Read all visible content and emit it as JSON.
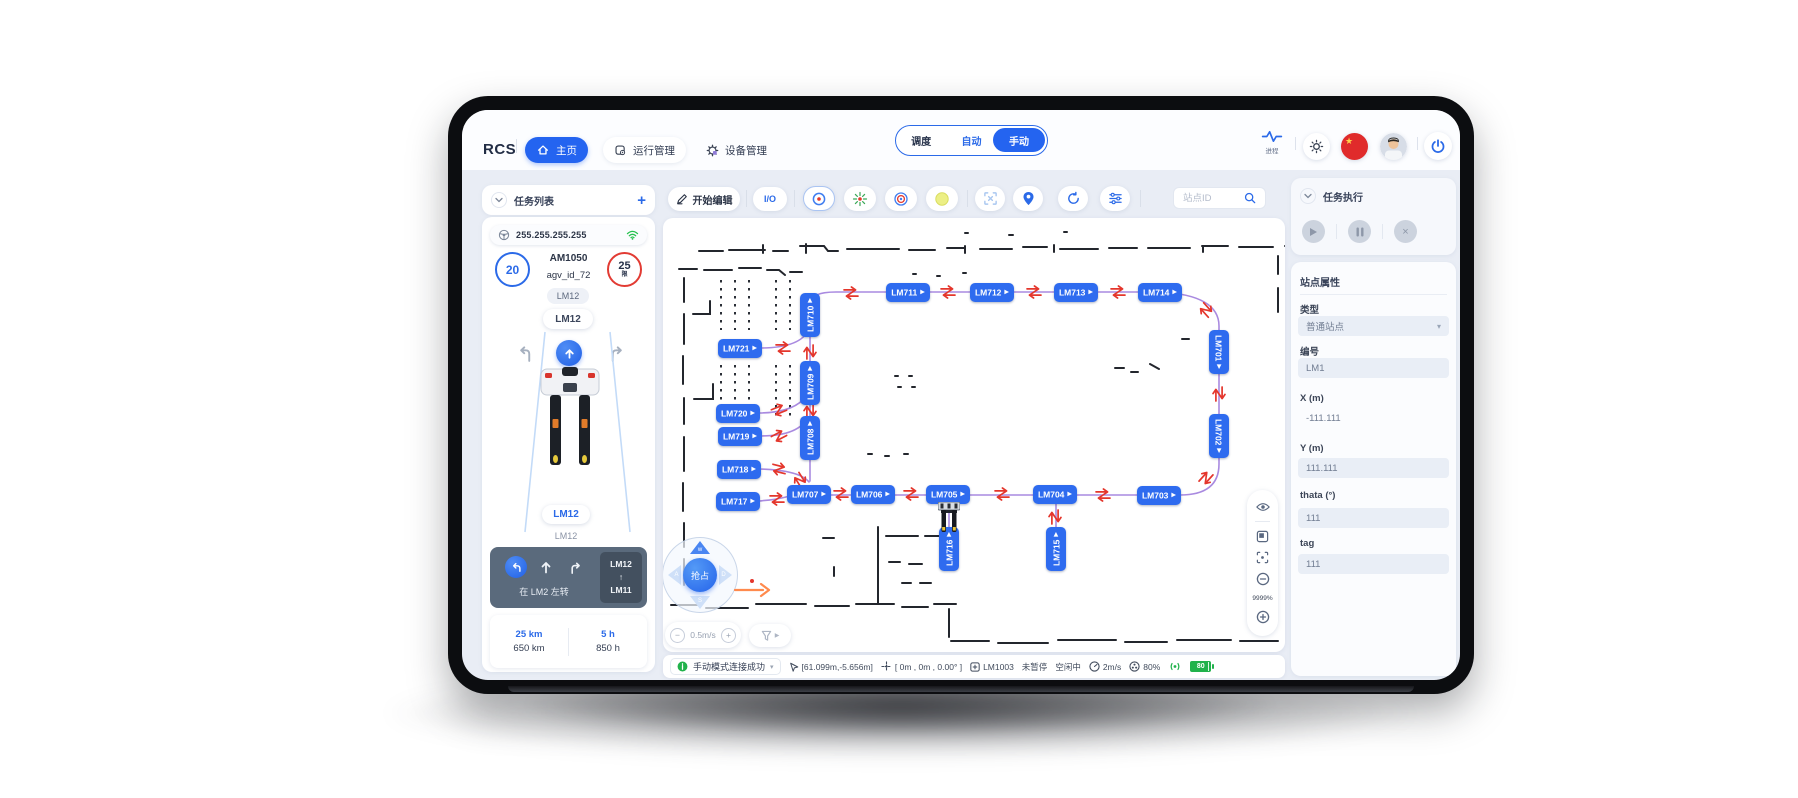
{
  "topbar": {
    "logo": "RCS",
    "nav": [
      {
        "label": "主页",
        "active": true
      },
      {
        "label": "运行管理",
        "active": false
      },
      {
        "label": "设备管理",
        "active": false
      }
    ],
    "modes": {
      "options": [
        "调度",
        "自动",
        "手动"
      ],
      "selected": "手动"
    },
    "process_label": "进程"
  },
  "sidebar": {
    "header_title": "任务列表",
    "add_label": "+",
    "ip": "255.255.255.255",
    "agv": {
      "battery_count": "20",
      "model": "AM1050",
      "agv_id": "agv_id_72",
      "limit_count": "25",
      "limit_sub": "限",
      "station_tag": "LM12",
      "station_pill": "LM12",
      "current_station": "LM12",
      "current_sub": "LM12"
    },
    "control": {
      "action_text": "在 LM2 左转",
      "route_from": "LM12",
      "route_arrow": "↑",
      "route_to": "LM11"
    },
    "stats": {
      "odometer_today": "25 km",
      "odometer_total": "650 km",
      "hours_today": "5 h",
      "hours_total": "850 h"
    }
  },
  "map": {
    "toolbar": {
      "edit_label": "开始编辑",
      "io_label": "I/O",
      "search_placeholder": "站点ID"
    },
    "speed_label": "0.5m/s",
    "zoom_label": "9999%",
    "joystick": {
      "center": "抢占",
      "up": "w",
      "left": "A",
      "right": "D",
      "down": "S"
    },
    "colors": {
      "node": "#2e6bef",
      "edge": "#a98ae0",
      "arrow": "#e4362c"
    },
    "nodes": [
      {
        "label": "LM711",
        "x": 245,
        "y": 74,
        "o": "h"
      },
      {
        "label": "LM712",
        "x": 329,
        "y": 74,
        "o": "h"
      },
      {
        "label": "LM713",
        "x": 413,
        "y": 74,
        "o": "h"
      },
      {
        "label": "LM714",
        "x": 497,
        "y": 74,
        "o": "h"
      },
      {
        "label": "LM710",
        "x": 147,
        "y": 97,
        "o": "v"
      },
      {
        "label": "LM721",
        "x": 77,
        "y": 130,
        "o": "h"
      },
      {
        "label": "LM709",
        "x": 147,
        "y": 165,
        "o": "v"
      },
      {
        "label": "LM720",
        "x": 75,
        "y": 195,
        "o": "h"
      },
      {
        "label": "LM719",
        "x": 77,
        "y": 218,
        "o": "h"
      },
      {
        "label": "LM708",
        "x": 147,
        "y": 220,
        "o": "v"
      },
      {
        "label": "LM718",
        "x": 76,
        "y": 251,
        "o": "h"
      },
      {
        "label": "LM717",
        "x": 75,
        "y": 283,
        "o": "h"
      },
      {
        "label": "LM707",
        "x": 146,
        "y": 276,
        "o": "h"
      },
      {
        "label": "LM706",
        "x": 210,
        "y": 276,
        "o": "h"
      },
      {
        "label": "LM705",
        "x": 285,
        "y": 276,
        "o": "h"
      },
      {
        "label": "LM704",
        "x": 392,
        "y": 276,
        "o": "h"
      },
      {
        "label": "LM703",
        "x": 496,
        "y": 277,
        "o": "h"
      },
      {
        "label": "LM701",
        "x": 556,
        "y": 134,
        "o": "vd"
      },
      {
        "label": "LM702",
        "x": 556,
        "y": 218,
        "o": "vd"
      },
      {
        "label": "LM716",
        "x": 286,
        "y": 331,
        "o": "v"
      },
      {
        "label": "LM715",
        "x": 393,
        "y": 331,
        "o": "v"
      }
    ],
    "edges": [
      "M147 86 Q147 74 173 74 L497 74",
      "M497 74 Q556 77 556 108 L556 246 Q556 277 517 277",
      "M517 277 L146 277",
      "M147 79 L147 263",
      "M97 130 Q138 130 146 111",
      "M95 195 Q132 195 144 177",
      "M97 218 Q136 218 145 199",
      "M96 251 Q136 252 146 264",
      "M95 283 Q128 281 141 271",
      "M286 285 L286 311",
      "M393 285 L393 311"
    ],
    "arrow_pairs": [
      {
        "x": 188,
        "y": 75,
        "r": 0
      },
      {
        "x": 285,
        "y": 74,
        "r": 0
      },
      {
        "x": 371,
        "y": 74,
        "r": 0
      },
      {
        "x": 455,
        "y": 74,
        "r": 0
      },
      {
        "x": 147,
        "y": 134,
        "r": 90
      },
      {
        "x": 147,
        "y": 193,
        "r": 90
      },
      {
        "x": 120,
        "y": 130,
        "r": 0
      },
      {
        "x": 116,
        "y": 192,
        "r": -22
      },
      {
        "x": 116,
        "y": 218,
        "r": -28
      },
      {
        "x": 543,
        "y": 92,
        "r": 48
      },
      {
        "x": 556,
        "y": 176,
        "r": 90
      },
      {
        "x": 543,
        "y": 260,
        "r": 132
      },
      {
        "x": 440,
        "y": 277,
        "r": 0
      },
      {
        "x": 339,
        "y": 276,
        "r": 0
      },
      {
        "x": 248,
        "y": 276,
        "r": 0
      },
      {
        "x": 178,
        "y": 276,
        "r": 0
      },
      {
        "x": 114,
        "y": 281,
        "r": 0
      },
      {
        "x": 116,
        "y": 251,
        "r": 14
      },
      {
        "x": 137,
        "y": 262,
        "r": 58
      },
      {
        "x": 392,
        "y": 299,
        "r": 90
      }
    ]
  },
  "right_panel": {
    "task_title": "任务执行",
    "props_title": "站点属性",
    "fields": {
      "type_label": "类型",
      "type_value": "普通站点",
      "id_label": "编号",
      "id_value": "LM1",
      "x_label": "X (m)",
      "x_value": "-111.111",
      "y_label": "Y (m)",
      "y_value": "111.111",
      "theta_label": "thata (°)",
      "theta_value": "111",
      "tag_label": "tag",
      "tag_value": "111"
    }
  },
  "statusbar": {
    "message": "手动模式连接成功",
    "position": "[61.099m,-5.656m]",
    "pose": "[ 0m , 0m , 0.00° ]",
    "station": "LM1003",
    "pause_state": "未暂停",
    "idle_state": "空闲中",
    "speed": "2m/s",
    "cpu": "80%",
    "battery": "80"
  }
}
